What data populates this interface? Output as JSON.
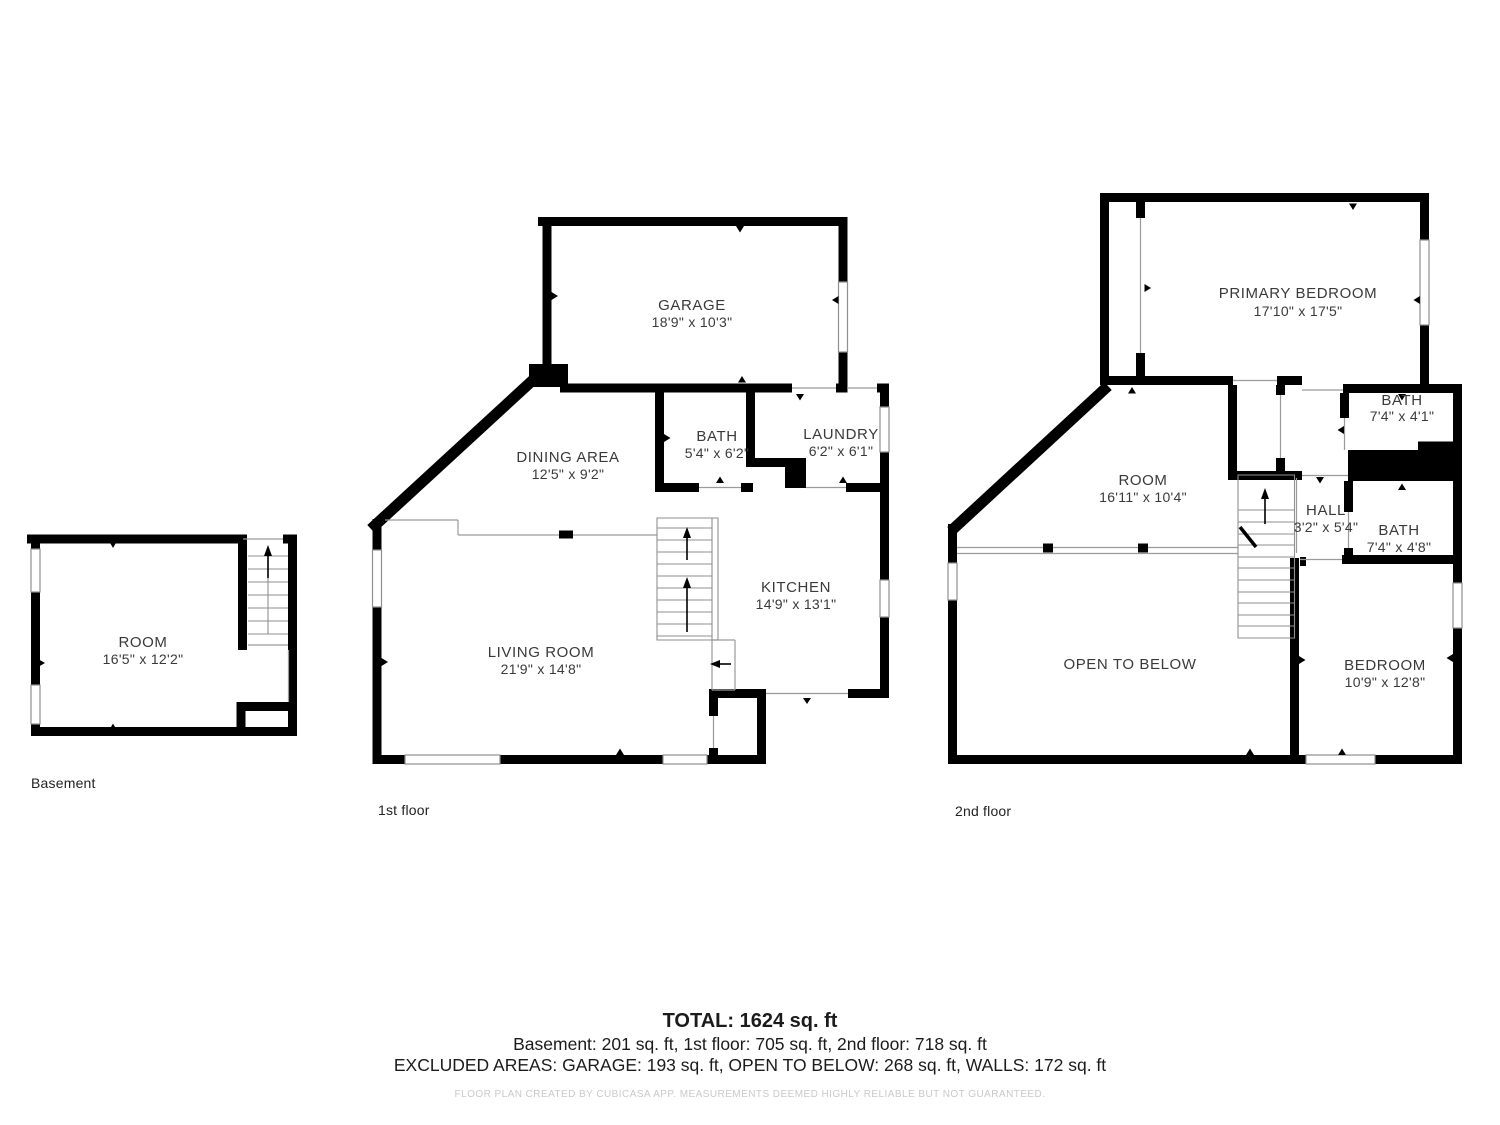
{
  "colors": {
    "wall": "#000000",
    "thin_line": "#9a9a9a",
    "label_text": "#3a3a3a",
    "disclaimer_text": "#c9c9c9"
  },
  "floors": {
    "basement": {
      "label": "Basement",
      "rooms": [
        {
          "name": "ROOM",
          "dims": "16'5\" x 12'2\""
        }
      ]
    },
    "first": {
      "label": "1st floor",
      "rooms": [
        {
          "name": "GARAGE",
          "dims": "18'9\" x 10'3\""
        },
        {
          "name": "DINING AREA",
          "dims": "12'5\" x 9'2\""
        },
        {
          "name": "BATH",
          "dims": "5'4\" x 6'2\""
        },
        {
          "name": "LAUNDRY",
          "dims": "6'2\" x 6'1\""
        },
        {
          "name": "KITCHEN",
          "dims": "14'9\" x 13'1\""
        },
        {
          "name": "LIVING ROOM",
          "dims": "21'9\" x 14'8\""
        }
      ]
    },
    "second": {
      "label": "2nd floor",
      "rooms": [
        {
          "name": "PRIMARY BEDROOM",
          "dims": "17'10\" x 17'5\""
        },
        {
          "name": "BATH",
          "dims": "7'4\" x 4'1\""
        },
        {
          "name": "ROOM",
          "dims": "16'11\" x 10'4\""
        },
        {
          "name": "HALL",
          "dims": "3'2\" x 5'4\""
        },
        {
          "name": "BATH",
          "dims": "7'4\" x 4'8\""
        },
        {
          "name": "OPEN TO BELOW",
          "dims": ""
        },
        {
          "name": "BEDROOM",
          "dims": "10'9\" x 12'8\""
        }
      ]
    }
  },
  "summary": {
    "total": "TOTAL: 1624 sq. ft",
    "breakdown": "Basement: 201 sq. ft, 1st floor: 705 sq. ft, 2nd floor: 718 sq. ft",
    "excluded": "EXCLUDED AREAS: GARAGE: 193 sq. ft, OPEN TO BELOW: 268 sq. ft, WALLS: 172 sq. ft",
    "disclaimer": "FLOOR PLAN CREATED BY CUBICASA APP. MEASUREMENTS DEEMED HIGHLY RELIABLE BUT NOT GUARANTEED."
  }
}
